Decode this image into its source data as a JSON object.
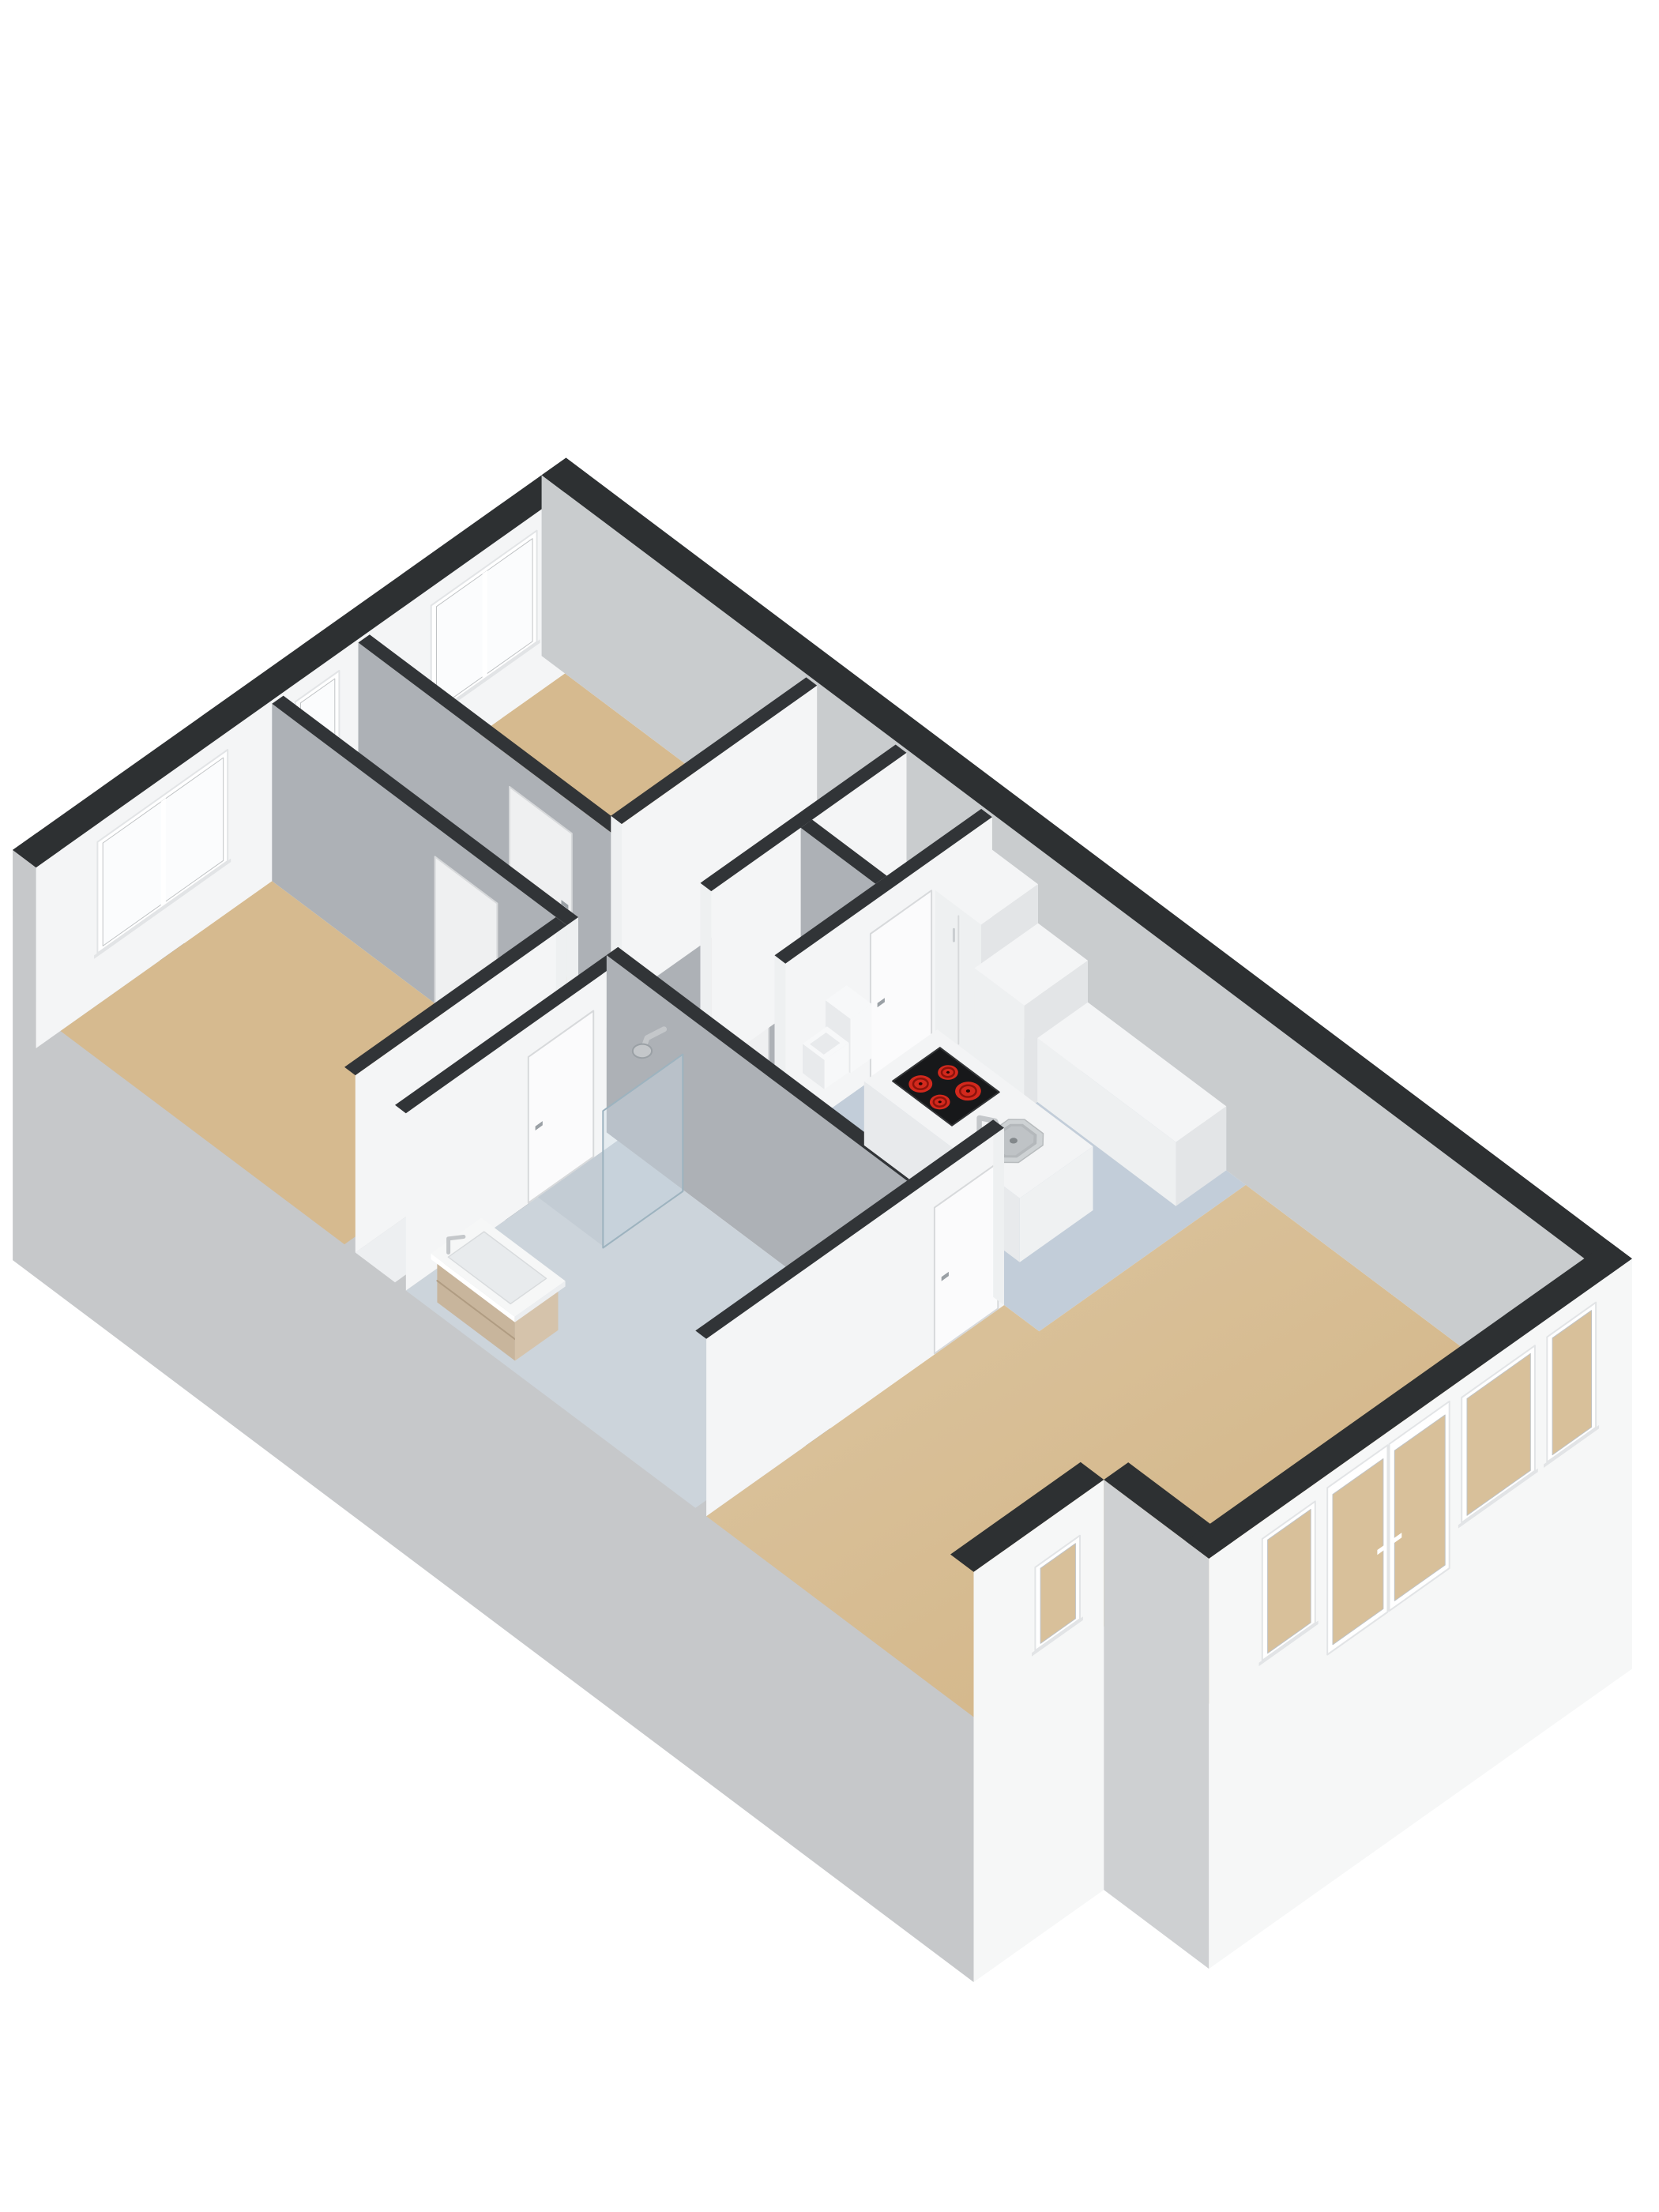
{
  "scene": {
    "description": "Isometric 3D floor plan render of an apartment, viewed from above at an angle on a white background",
    "projection": {
      "U": [
        103,
        -73
      ],
      "V": [
        98.5,
        74
      ],
      "HZ": 88,
      "O": [
        76.5,
        1305
      ],
      "depth": -3.3
    }
  },
  "colors": {
    "background": "#ffffff",
    "wallCap": "#2d3032",
    "wallCapIn": "#313437",
    "wallLit": "#f4f5f6",
    "wallGray": "#adb1b6",
    "wallNE": "#c9ccce",
    "wallEnd": "#eef0f1",
    "extSW": "#c6c8ca",
    "extN2": "#ced0d2",
    "extFront": "#f6f7f7",
    "floorTan": "#d6ba8f",
    "floorWhite": "#f1f2f3",
    "floorHall": "#edeff1",
    "floorBath": "#ccd4db",
    "floorShower": "#c3ccd4",
    "floorKitchen": "#c2cdd9",
    "tanGradLight": "#ddc7a3",
    "tanGradDeep": "#d1b282",
    "door": "#eff0f1",
    "doorLit": "#fbfbfc",
    "doorSeam": "#d7d9db",
    "handle": "#9aa0a5",
    "handleLit": "#c9cdd0",
    "windowFrame": "#ffffff",
    "frameShade": "#e2e4e6",
    "glazeBright": "#fbfcfd",
    "glazeTan": "#d8c09a",
    "glazeLine": "#c0c3c5",
    "cooktop": "#17181a",
    "cooktopEdge": "#323436",
    "burner": "#d3291d",
    "burnerRing": "#8c130b",
    "burnerDot": "#260604",
    "sinkRim": "#ced2d4",
    "sinkBasin": "#b4b8bb",
    "sinkDrain": "#82878a",
    "chrome": "#c4c7ca",
    "chromeDark": "#9aa0a5",
    "wood": "#c8b59c",
    "woodShade": "#b09c82",
    "woodEnd": "#d5c3ab",
    "cabTop": "#f4f5f6",
    "cabSW": "#eef0f1",
    "cabSE": "#e3e5e7",
    "islandTop": "#f3f4f5",
    "islandSW": "#e8eaec",
    "islandSE": "#eff1f2",
    "toiletWhite": "#f7f8f9",
    "toiletShade": "#e8eaec",
    "glass": "rgba(205,222,232,0.38)",
    "glassEdge": "#9db3bf",
    "vanityTop": "#f6f7f7",
    "basinInset": "#e8ebed"
  },
  "plan": {
    "back": [
      {
        "kind": "extFaceV",
        "name": "exterior-sw-outer-face",
        "u": -0.3,
        "v": [
          -0.3,
          12.05
        ],
        "fill": "extSW"
      },
      {
        "kind": "cap",
        "name": "exterior-sw-wall-cap",
        "rect": [
          -0.3,
          -0.3,
          0,
          12.05
        ],
        "fill": "wallCap"
      }
    ],
    "floors": [
      {
        "name": "bedroom-1-floor",
        "rect": [
          0,
          0,
          2.6,
          3.65
        ],
        "color": "floorTan"
      },
      {
        "name": "corridor-floor",
        "rect": [
          2.74,
          0,
          3.66,
          8.16
        ],
        "color": "floorTan"
      },
      {
        "name": "bedroom-2-floor",
        "rect": [
          3.8,
          0,
          6.2,
          3.1
        ],
        "color": "floorTan"
      },
      {
        "name": "closet-floor",
        "rect": [
          3.8,
          3.24,
          6.2,
          4.25
        ],
        "color": "floorWhite"
      },
      {
        "name": "toilet-room-floor",
        "rect": [
          3.8,
          4.39,
          4.9,
          5.35
        ],
        "color": "floorWhite"
      },
      {
        "name": "storage-floor",
        "rect": [
          5.04,
          4.39,
          6.2,
          5.35
        ],
        "color": "floorWhite"
      },
      {
        "name": "hall-floor",
        "rect": [
          0,
          3.79,
          2.74,
          4.3
        ],
        "color": "floorHall"
      },
      {
        "name": "bathroom-floor",
        "rect": [
          0,
          4.44,
          2.6,
          8.16
        ],
        "color": "floorBath"
      },
      {
        "name": "shower-tray",
        "rect": [
          1.62,
          4.44,
          2.6,
          5.3
        ],
        "color": "floorShower"
      },
      {
        "name": "kitchen-floor",
        "rect": [
          3.66,
          5.49,
          6.2,
          8.75
        ],
        "color": "floorKitchen"
      },
      {
        "name": "living-room-floor",
        "poly": [
          [
            0,
            8.3
          ],
          [
            3.66,
            8.3
          ],
          [
            3.66,
            8.75
          ],
          [
            6.2,
            8.75
          ],
          [
            6.2,
            13.1
          ],
          [
            1.6,
            13.1
          ],
          [
            1.6,
            11.75
          ],
          [
            0,
            11.75
          ]
        ],
        "color": "url(#tanGrad)"
      }
    ],
    "elements": [
      {
        "kind": "wallU",
        "name": "exterior-nw-wall",
        "u": [
          -0.3,
          6.5
        ],
        "v0": -0.3,
        "t": 0.3,
        "h": 2.6,
        "face": "wallLit",
        "cap": "wallCap",
        "windows": [
          {
            "name": "bedroom-1-window",
            "u0": 0.45,
            "u1": 2.05,
            "s": 0.75,
            "t": 2.35,
            "glaze": "glazeBright",
            "mullion": 1.25
          },
          {
            "name": "corridor-window",
            "u0": 2.88,
            "u1": 3.42,
            "s": 0.9,
            "t": 2.35,
            "glaze": "glazeBright"
          },
          {
            "name": "bedroom-2-window",
            "u0": 4.55,
            "u1": 5.85,
            "s": 0.75,
            "t": 2.35,
            "glaze": "glazeBright",
            "mullion": 5.2
          }
        ]
      },
      {
        "kind": "wallV",
        "name": "exterior-ne-wall",
        "v": [
          -0.3,
          13.4
        ],
        "u0": 6.2,
        "t": 0.3,
        "h": 2.6,
        "face": "wallNE",
        "cap": "wallCap"
      },
      {
        "kind": "wallV",
        "name": "corridor-ne-wall",
        "v": [
          0,
          5.35
        ],
        "u0": 3.66,
        "t": 0.14,
        "h": 2.55,
        "face": "wallGray",
        "cap": "wallCapIn",
        "endV1": true,
        "doors": [
          {
            "name": "bedroom-2-door",
            "a0": 1.95,
            "a1": 2.75,
            "handle": 2.62
          },
          {
            "name": "toilet-door",
            "a0": 4.55,
            "a1": 5.28,
            "handle": 4.64
          }
        ]
      },
      {
        "kind": "wallU",
        "name": "bedroom-2-se-wall",
        "u": [
          3.8,
          6.2
        ],
        "v0": 3.1,
        "t": 0.14,
        "h": 2.55,
        "face": "wallLit",
        "cap": "wallCapIn",
        "endU0": true
      },
      {
        "kind": "wallU",
        "name": "closet-se-wall",
        "u": [
          3.8,
          6.2
        ],
        "v0": 4.25,
        "t": 0.14,
        "h": 2.55,
        "face": "wallLit",
        "cap": "wallCapIn",
        "endU0": true
      },
      {
        "kind": "wallV",
        "name": "toilet-storage-wall",
        "v": [
          4.39,
          5.35
        ],
        "u0": 4.9,
        "t": 0.14,
        "h": 2.55,
        "face": "wallGray",
        "cap": "wallCapIn"
      },
      {
        "kind": "wallU",
        "name": "kitchen-nw-wall",
        "u": [
          3.66,
          6.2
        ],
        "v0": 5.35,
        "t": 0.14,
        "h": 2.55,
        "face": "wallLit",
        "cap": "wallCapIn",
        "endU0": true,
        "doors": [
          {
            "name": "kitchen-door",
            "a0": 4.7,
            "a1": 5.45,
            "handle": 4.78
          }
        ]
      },
      {
        "kind": "toilet",
        "name": "toilet"
      },
      {
        "kind": "box",
        "name": "fridge-cabinet",
        "rect": [
          5.5,
          5.49,
          6.2,
          6.08
        ],
        "h": 2.08,
        "seam": true
      },
      {
        "kind": "box",
        "name": "oven-cabinet",
        "rect": [
          5.42,
          6.08,
          6.2,
          6.72
        ],
        "h": 1.52
      },
      {
        "kind": "box",
        "name": "kitchen-counter",
        "rect": [
          5.58,
          6.72,
          6.2,
          8.5
        ],
        "h": 0.92
      },
      {
        "kind": "wallV",
        "name": "bedroom-1-corridor-wall",
        "v": [
          0,
          3.79
        ],
        "u0": 2.6,
        "t": 0.14,
        "h": 2.55,
        "face": "wallGray",
        "cap": "wallCapIn",
        "endV1": true,
        "doors": [
          {
            "name": "bedroom-1-door",
            "a0": 2.1,
            "a1": 2.9,
            "handle": 2.77
          }
        ]
      },
      {
        "kind": "wallU",
        "name": "bedroom-1-se-wall",
        "u": [
          0,
          2.6
        ],
        "v0": 3.65,
        "t": 0.14,
        "h": 2.55,
        "face": "wallLit",
        "cap": "wallCapIn",
        "endU1": true
      },
      {
        "kind": "wallU",
        "name": "bathroom-nw-wall",
        "u": [
          0,
          2.6
        ],
        "v0": 4.3,
        "t": 0.14,
        "h": 2.55,
        "face": "wallLit",
        "cap": "wallCapIn",
        "endU1": true,
        "doors": [
          {
            "name": "bathroom-door",
            "a0": 1.5,
            "a1": 2.3,
            "handle": 1.58
          }
        ]
      },
      {
        "kind": "wallV",
        "name": "bathroom-ne-wall",
        "v": [
          4.3,
          8.16
        ],
        "u0": 2.6,
        "t": 0.14,
        "h": 2.55,
        "face": "wallGray",
        "cap": "wallCapIn",
        "endV1": true
      },
      {
        "kind": "shower",
        "name": "shower-head"
      },
      {
        "kind": "glass",
        "name": "shower-glass-panel",
        "u0": 1.6,
        "u1": 2.58,
        "v": 5.3,
        "h": 1.98
      },
      {
        "kind": "vanity",
        "name": "bathroom-vanity"
      },
      {
        "kind": "box",
        "name": "kitchen-island",
        "rect": [
          4.12,
          6.02,
          5.02,
          8.02
        ],
        "h": 0.92,
        "island": true
      },
      {
        "kind": "cooktop",
        "name": "island-cooktop",
        "rect": [
          4.3,
          6.2,
          4.88,
          6.96
        ],
        "burners": [
          [
            4.45,
            6.4,
            0.105
          ],
          [
            4.72,
            6.47,
            0.09
          ],
          [
            4.42,
            6.68,
            0.09
          ],
          [
            4.69,
            6.76,
            0.115
          ]
        ]
      },
      {
        "kind": "sink",
        "name": "island-sink"
      },
      {
        "kind": "wallU",
        "name": "living-room-nw-wall",
        "u": [
          0,
          3.66
        ],
        "v0": 8.16,
        "t": 0.14,
        "h": 2.55,
        "face": "wallLit",
        "cap": "wallCapIn",
        "endU1": true,
        "doors": [
          {
            "name": "living-room-door",
            "a0": 2.8,
            "a1": 3.58,
            "handle": 2.88
          }
        ]
      }
    ],
    "front": [
      {
        "kind": "extU",
        "name": "notch-se-wall",
        "faceV": 12.05,
        "u": [
          -0.3,
          1.3
        ],
        "capRect": [
          -0.3,
          11.75,
          1.3,
          12.05
        ],
        "fill": "extFront",
        "windows": [
          {
            "name": "notch-window",
            "u0": 0.45,
            "u1": 1.0,
            "s": 0.85,
            "t": 2.05
          }
        ]
      },
      {
        "kind": "extV",
        "name": "notch-side-wall",
        "faceU": 1.3,
        "v": [
          12.05,
          13.4
        ],
        "capRect": [
          1.3,
          12.05,
          1.6,
          13.4
        ],
        "fill": "extN2"
      },
      {
        "kind": "extU",
        "name": "exterior-se-wall",
        "faceV": 13.4,
        "u": [
          1.3,
          6.5
        ],
        "capRect": [
          1.3,
          13.1,
          6.5,
          13.4
        ],
        "fill": "extFront",
        "windows": [
          {
            "name": "living-room-window-1",
            "u0": 1.95,
            "u1": 2.6,
            "s": 0.6,
            "t": 2.35
          },
          {
            "name": "living-room-window-2",
            "u0": 4.4,
            "u1": 5.3,
            "s": 0.55,
            "t": 2.35
          },
          {
            "name": "living-room-window-3",
            "u0": 5.45,
            "u1": 6.05,
            "s": 0.55,
            "t": 2.35
          }
        ],
        "doors": [
          {
            "name": "french-door-left",
            "u0": 2.75,
            "u1": 3.49,
            "handle": 3.4
          },
          {
            "name": "french-door-right",
            "u0": 3.51,
            "u1": 4.25,
            "handle": 3.6
          }
        ]
      }
    ]
  }
}
